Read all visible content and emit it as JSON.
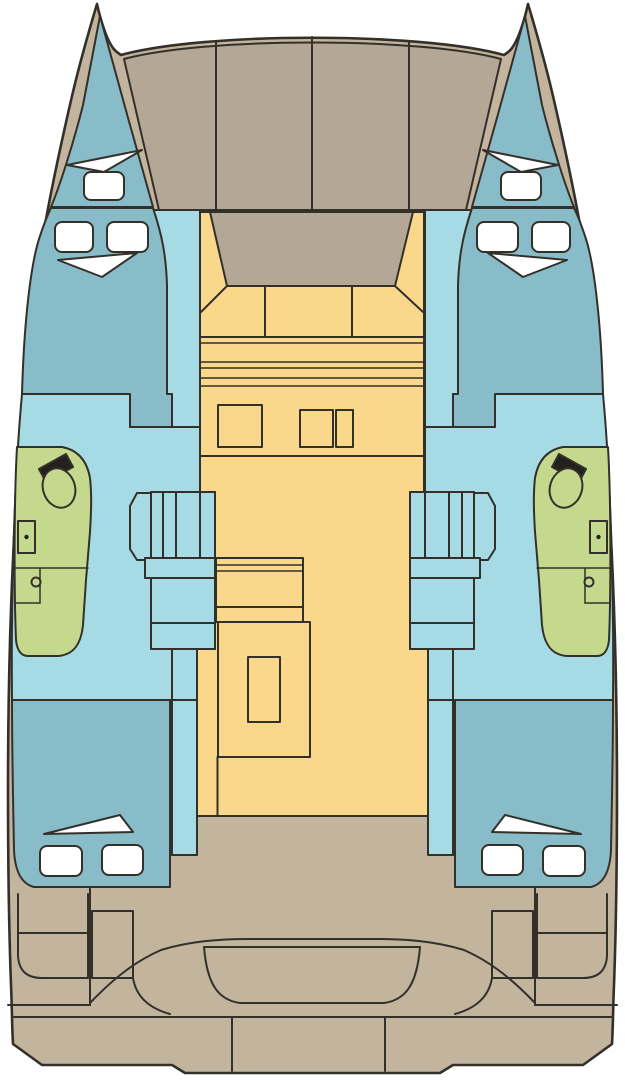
{
  "page": {
    "background": "#ffffff"
  },
  "diagram": {
    "type": "catamaran-deck-plan",
    "view": "top-down",
    "bow_direction": "top",
    "hull_count": 2,
    "colors": {
      "deck": "#c3b49e",
      "foredeck": "#b5a795",
      "cabin": "#88bcc8",
      "floor": "#a6dbe5",
      "salon": "#f9d88b",
      "head": "#c5d98e",
      "fixture": "#22211d",
      "window": "#ffffff",
      "outline": "#33302a"
    },
    "areas": [
      {
        "id": "hull-silhouette",
        "color_key": "deck"
      },
      {
        "id": "foredeck-panels",
        "color_key": "foredeck"
      },
      {
        "id": "salon-front-roof",
        "color_key": "foredeck"
      },
      {
        "id": "salon-floor",
        "color_key": "salon"
      },
      {
        "id": "bow-berth",
        "color_key": "cabin"
      },
      {
        "id": "forward-cabin",
        "color_key": "cabin"
      },
      {
        "id": "aft-cabin",
        "color_key": "cabin"
      },
      {
        "id": "hull-floor",
        "color_key": "floor"
      },
      {
        "id": "companionway-steps",
        "color_key": "floor"
      },
      {
        "id": "head-bathroom",
        "color_key": "head"
      },
      {
        "id": "head-counter",
        "color_key": "fixture"
      },
      {
        "id": "hatches-windows",
        "color_key": "window"
      },
      {
        "id": "cockpit-bench",
        "color_key": "deck"
      },
      {
        "id": "stern-steps",
        "color_key": "deck"
      }
    ]
  }
}
